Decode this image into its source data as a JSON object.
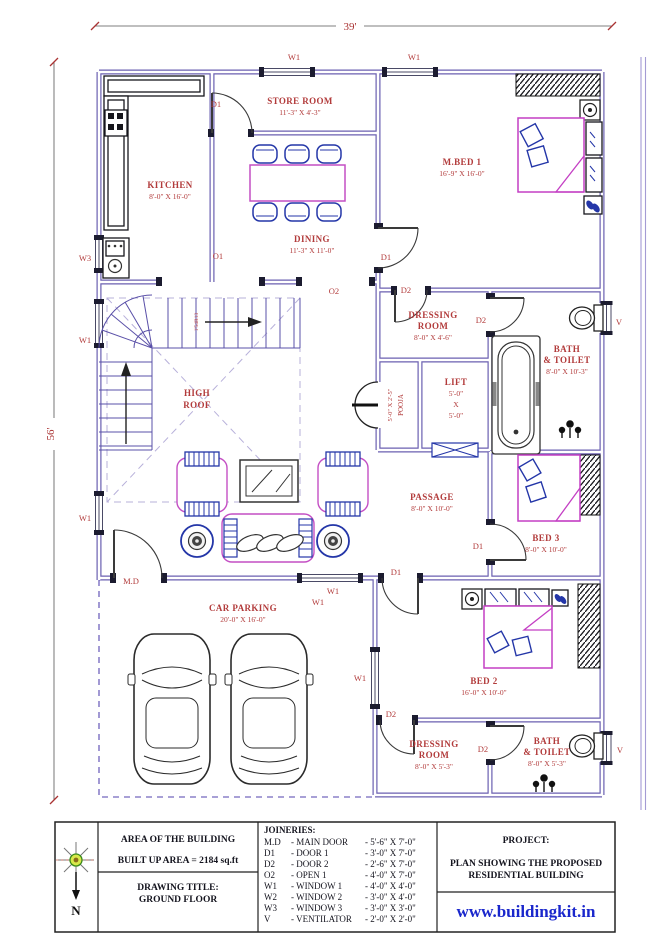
{
  "colors": {
    "wall": "#6a5fb0",
    "room_label": "#b23b3b",
    "furniture_pink": "#c43fc4",
    "furniture_blue": "#2436a8",
    "website_blue": "#1a27cc",
    "high_roof_dash": "#b7b0da"
  },
  "dimensions": {
    "width": "39'",
    "height": "56'"
  },
  "openings": {
    "md": "M.D",
    "d1": "D1",
    "d2": "D2",
    "o1": "O1",
    "o2": "O2",
    "w1": "W1",
    "w3": "W3",
    "v": "V"
  },
  "stair_note": "1'54R13",
  "rooms": {
    "store": {
      "name": "STORE ROOM",
      "size": "11'-3\" X 4'-3\""
    },
    "kitchen": {
      "name": "KITCHEN",
      "size": "8'-0\" X 16'-0\""
    },
    "dining": {
      "name": "DINING",
      "size": "11'-3\" X 11'-0\""
    },
    "mbed1": {
      "name": "M.BED 1",
      "size": "16'-9\" X 16'-0\""
    },
    "dressing1": {
      "line1": "DRESSING",
      "line2": "ROOM",
      "size": "8'-0\" X 4'-6\""
    },
    "bath1": {
      "line1": "BATH",
      "line2": "& TOILET",
      "size": "8'-0\" X 10'-3\""
    },
    "lift": {
      "name": "LIFT",
      "dim1": "5'-0\"",
      "dim2": "X",
      "dim3": "5'-0\""
    },
    "pooja": {
      "name": "POOJA",
      "size": "5'-0\" X 2'-5\""
    },
    "high_roof": {
      "line1": "HIGH",
      "line2": "ROOF"
    },
    "passage": {
      "name": "PASSAGE",
      "size": "8'-0\" X 10'-0\""
    },
    "bed3": {
      "name": "BED 3",
      "size": "8'-0\" X 10'-0\""
    },
    "car_parking": {
      "name": "CAR PARKING",
      "size": "20'-0\" X 16'-0\""
    },
    "bed2": {
      "name": "BED 2",
      "size": "16'-0\" X 10'-0\""
    },
    "dressing2": {
      "line1": "DRESSING",
      "line2": "ROOM",
      "size": "8'-0\" X 5'-3\""
    },
    "bath2": {
      "line1": "BATH",
      "line2": "& TOILET",
      "size": "8'-0\" X 5'-3\""
    }
  },
  "title_block": {
    "area_heading": "AREA OF THE BUILDING",
    "built_up_area": "BUILT UP AREA   = 2184 sq.ft",
    "drawing_title_label": "DRAWING TITLE:",
    "drawing_title": "GROUND FLOOR",
    "joineries_heading": "JOINERIES:",
    "joineries": [
      {
        "code": "M.D",
        "name": "- MAIN DOOR",
        "size": "- 5'-6\" X 7'-0\""
      },
      {
        "code": "D1",
        "name": "- DOOR 1",
        "size": "- 3'-0\" X 7'-0\""
      },
      {
        "code": "D2",
        "name": "- DOOR 2",
        "size": "- 2'-6\" X 7'-0\""
      },
      {
        "code": "O2",
        "name": "- OPEN 1",
        "size": "- 4'-0\" X 7'-0\""
      },
      {
        "code": "W1",
        "name": "- WINDOW 1",
        "size": "- 4'-0\" X 4'-0\""
      },
      {
        "code": "W2",
        "name": "- WINDOW 2",
        "size": "- 3'-0\" X 4'-0\""
      },
      {
        "code": "W3",
        "name": "- WINDOW 3",
        "size": "- 3'-0\" X 3'-0\""
      },
      {
        "code": "V",
        "name": "- VENTILATOR",
        "size": "- 2'-0\" X 2'-0\""
      }
    ],
    "project_label": "PROJECT:",
    "project_line1": "PLAN SHOWING THE PROPOSED",
    "project_line2": "RESIDENTIAL BUILDING",
    "website": "www.buildingkit.in",
    "north_label": "N"
  }
}
